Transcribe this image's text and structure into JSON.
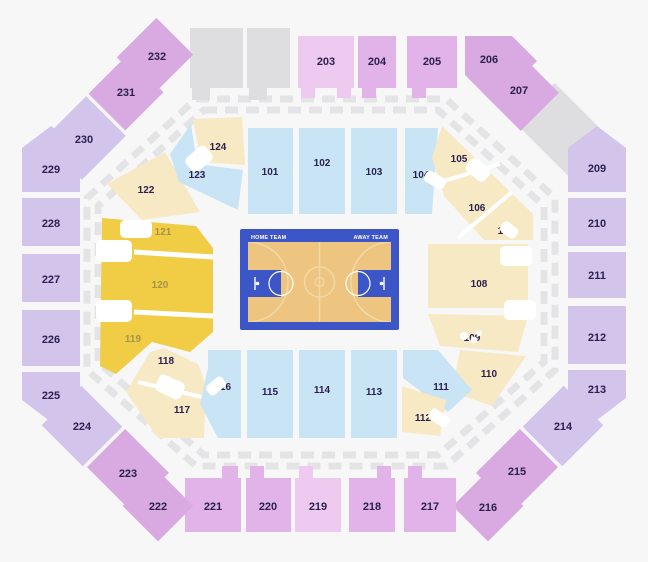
{
  "court": {
    "home_label": "HOME TEAM",
    "away_label": "AWAY TEAM"
  },
  "palette": {
    "background": "#f7f7f8",
    "lower_blue": "#c9e4f4",
    "lower_cream": "#f6e9c4",
    "lower_gold": "#f1cd45",
    "upper_lavender": "#d3c4ec",
    "upper_purple": "#d9a9e1",
    "upper_pink": "#e2b3e8",
    "upper_pink_light": "#eecaf0",
    "unavailable_gray": "#dedee1",
    "suite_gray": "#e4e4e6",
    "court_blue": "#3c56c8",
    "court_floor": "#edc580",
    "court_line": "#f2d9a4",
    "label_dark": "#2b2150",
    "label_gold": "#a6934a"
  },
  "sections": {
    "lower": [
      {
        "id": "101",
        "label": "101"
      },
      {
        "id": "102",
        "label": "102"
      },
      {
        "id": "103",
        "label": "103"
      },
      {
        "id": "104",
        "label": "104"
      },
      {
        "id": "105",
        "label": "105"
      },
      {
        "id": "106",
        "label": "106"
      },
      {
        "id": "107",
        "label": "107"
      },
      {
        "id": "108",
        "label": "108"
      },
      {
        "id": "109",
        "label": "109"
      },
      {
        "id": "110",
        "label": "110"
      },
      {
        "id": "111",
        "label": "111"
      },
      {
        "id": "112",
        "label": "112"
      },
      {
        "id": "113",
        "label": "113"
      },
      {
        "id": "114",
        "label": "114"
      },
      {
        "id": "115",
        "label": "115"
      },
      {
        "id": "116",
        "label": "116"
      },
      {
        "id": "117",
        "label": "117"
      },
      {
        "id": "118",
        "label": "118"
      },
      {
        "id": "119",
        "label": "119"
      },
      {
        "id": "120",
        "label": "120"
      },
      {
        "id": "121",
        "label": "121"
      },
      {
        "id": "122",
        "label": "122"
      },
      {
        "id": "123",
        "label": "123"
      },
      {
        "id": "124",
        "label": "124"
      }
    ],
    "upper": [
      {
        "id": "203",
        "label": "203"
      },
      {
        "id": "204",
        "label": "204"
      },
      {
        "id": "205",
        "label": "205"
      },
      {
        "id": "206",
        "label": "206"
      },
      {
        "id": "207",
        "label": "207"
      },
      {
        "id": "209",
        "label": "209"
      },
      {
        "id": "210",
        "label": "210"
      },
      {
        "id": "211",
        "label": "211"
      },
      {
        "id": "212",
        "label": "212"
      },
      {
        "id": "213",
        "label": "213"
      },
      {
        "id": "214",
        "label": "214"
      },
      {
        "id": "215",
        "label": "215"
      },
      {
        "id": "216",
        "label": "216"
      },
      {
        "id": "217",
        "label": "217"
      },
      {
        "id": "218",
        "label": "218"
      },
      {
        "id": "219",
        "label": "219"
      },
      {
        "id": "220",
        "label": "220"
      },
      {
        "id": "221",
        "label": "221"
      },
      {
        "id": "222",
        "label": "222"
      },
      {
        "id": "223",
        "label": "223"
      },
      {
        "id": "224",
        "label": "224"
      },
      {
        "id": "225",
        "label": "225"
      },
      {
        "id": "226",
        "label": "226"
      },
      {
        "id": "227",
        "label": "227"
      },
      {
        "id": "228",
        "label": "228"
      },
      {
        "id": "229",
        "label": "229"
      },
      {
        "id": "230",
        "label": "230"
      },
      {
        "id": "231",
        "label": "231"
      },
      {
        "id": "232",
        "label": "232"
      }
    ]
  }
}
